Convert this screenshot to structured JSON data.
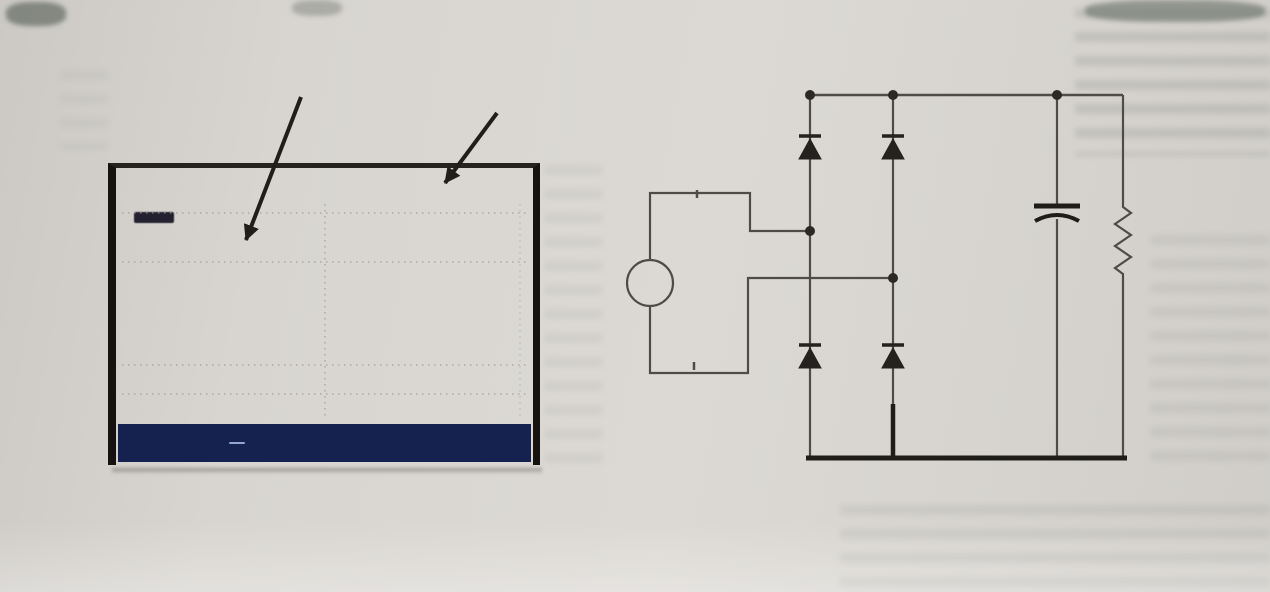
{
  "figure": {
    "caption": "图1 单相整流器的电路与电压、电流波形"
  },
  "annotations": {
    "current_label": "电流",
    "voltage_label": "电压"
  },
  "oscilloscope": {
    "status_bar": {
      "frequency": "59.99Hz",
      "marker": "0",
      "clock": "122:14",
      "channels": "4 ch",
      "right_indicator": "-0"
    },
    "footer": {
      "date": "10/25/06",
      "time": "04:17:36",
      "config": "120V 60Hz 3Ø WYE",
      "mode": "DETAIL 1"
    },
    "menu": {
      "cell1_top": "U A W",
      "phases": [
        "L1",
        "L2",
        "L3"
      ],
      "cell2_pill": "SCOPE",
      "cell3_top": "CURSOR",
      "cell3_on": "ON",
      "cell3_off": "OFF",
      "cell4_top": "ZOOM 2",
      "cell4_bottom": "x200 %"
    }
  },
  "circuit": {
    "source_label": "AC",
    "diode_top_left": "D1",
    "diode_top_right": "D2",
    "diode_bottom_left": "D4",
    "diode_bottom_right": "D3",
    "capacitor_label": "C",
    "resistor_label": "R"
  },
  "waveform": {
    "mid_y": 134,
    "sine": {
      "zero_up_x": 72,
      "period": 196,
      "amplitude": 100,
      "x_start": 6,
      "x_end": 412
    },
    "current": {
      "up_centers": [
        121,
        317
      ],
      "up_height": 64,
      "up_width": 13,
      "down_centers": [
        23,
        219,
        415
      ],
      "down_depth": 52,
      "down_width": 9
    },
    "pink_segments": [
      [
        72,
        100
      ],
      [
        284,
        307
      ]
    ]
  },
  "colors": {
    "paper": "#d8d5d0",
    "scope_bg": "#ded8ca",
    "menu_blue": "#2d3f8e",
    "chip_dark": "#0a0e1f",
    "voltage_trace": "#5a4e45",
    "current_trace": "#3f3a34",
    "pink": "#b2566c",
    "wire": "#4f4c47",
    "ink": "#14110d"
  }
}
